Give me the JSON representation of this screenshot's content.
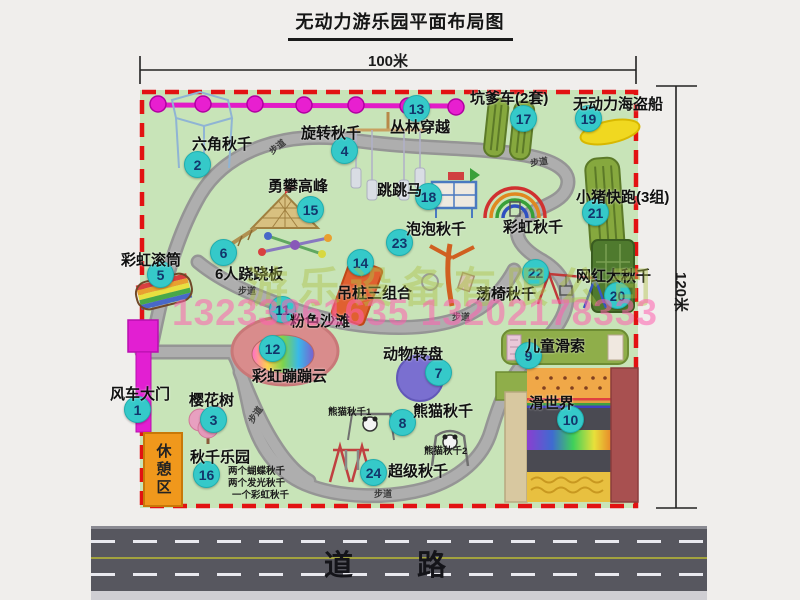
{
  "title": "无动力游乐园平面布局图",
  "dimensions": {
    "width_label": "100米",
    "height_label": "120米"
  },
  "road": {
    "label": "道 路"
  },
  "watermark": {
    "company": "游乐设备有限公司",
    "phones": "13233861635 13202178333"
  },
  "rest_area_label": "休憩区",
  "path_label": "步道",
  "colors": {
    "park_green": "#c8e4b8",
    "path_gray": "#a2a2a2",
    "border_red": "#e21212",
    "badge_teal": "#35c9c9",
    "zipline_magenta": "#e21cc7",
    "rest_orange": "#f0981c",
    "road_gray": "#57575f"
  },
  "attractions": [
    {
      "num": "1",
      "label": "风车大门"
    },
    {
      "num": "2",
      "label": "六角秋千"
    },
    {
      "num": "3",
      "label": "樱花树"
    },
    {
      "num": "4",
      "label": "旋转秋千"
    },
    {
      "num": "5",
      "label": "彩虹滚筒"
    },
    {
      "num": "6",
      "label": "6人跷跷板"
    },
    {
      "num": "7",
      "label": "动物转盘"
    },
    {
      "num": "8",
      "label": "熊猫秋千"
    },
    {
      "num": "9",
      "label": "儿童滑索"
    },
    {
      "num": "10",
      "label": "滑世界"
    },
    {
      "num": "11",
      "label": "粉色沙滩"
    },
    {
      "num": "12",
      "label": "彩虹蹦蹦云"
    },
    {
      "num": "13",
      "label": "丛林穿越"
    },
    {
      "num": "14",
      "label": "吊桩三组合"
    },
    {
      "num": "15",
      "label": "勇攀高峰"
    },
    {
      "num": "16",
      "label": "秋千乐园"
    },
    {
      "num": "17",
      "label": "坑爹车(2套)"
    },
    {
      "num": "18",
      "label": "跳跳马"
    },
    {
      "num": "19",
      "label": "无动力海盗船"
    },
    {
      "num": "20",
      "label": "网红大秋千"
    },
    {
      "num": "21",
      "label": "小猪快跑(3组)"
    },
    {
      "num": "22",
      "label": "荡椅秋千"
    },
    {
      "num": "23",
      "label": "泡泡秋千"
    },
    {
      "num": "24",
      "label": "超级秋千"
    }
  ],
  "extra_labels": {
    "rainbow_swing": "彩虹秋千",
    "panda_swing_1": "熊猫秋千1",
    "panda_swing_2": "熊猫秋千2",
    "swing_park_items": [
      "两个蝴蝶秋千",
      "两个发光秋千",
      "一个彩虹秋千"
    ]
  }
}
